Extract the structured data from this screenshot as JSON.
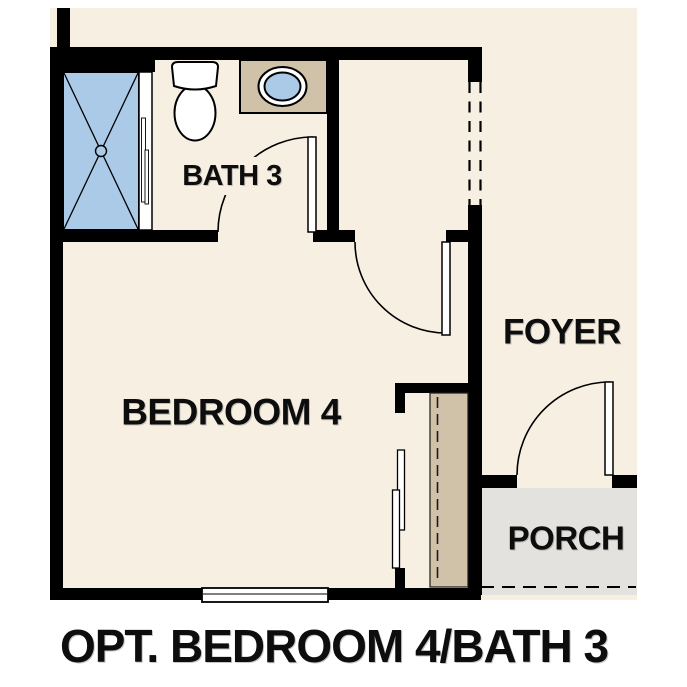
{
  "title": {
    "caption": "OPT. BEDROOM 4/BATH 3"
  },
  "rooms": {
    "bath": {
      "label": "BATH 3"
    },
    "bedroom": {
      "label": "BEDROOM 4"
    },
    "foyer": {
      "label": "FOYER"
    },
    "porch": {
      "label": "PORCH"
    }
  },
  "fixtures": {
    "shower": "shower-pan-icon",
    "toilet": "toilet-icon",
    "sink": "vanity-sink-icon",
    "closet": "closet-shelf-icon",
    "bath_door": "swing-door-icon",
    "bedroom_door": "swing-door-icon",
    "entry_door": "swing-door-icon",
    "bypass_doors": "bypass-closet-door-icon",
    "window": "window-icon",
    "cased_opening": "dashed-opening-icon",
    "porch_edge": "dashed-slab-edge-icon"
  },
  "colors": {
    "page_bg": "#ffffff",
    "floor_cream": "#f7efe2",
    "porch_gray": "#e3e2de",
    "fixture_blue": "#aacae8",
    "cabinet_tan": "#cfc2a9",
    "wall_black": "#000000",
    "text_black": "#0d0d0d"
  }
}
